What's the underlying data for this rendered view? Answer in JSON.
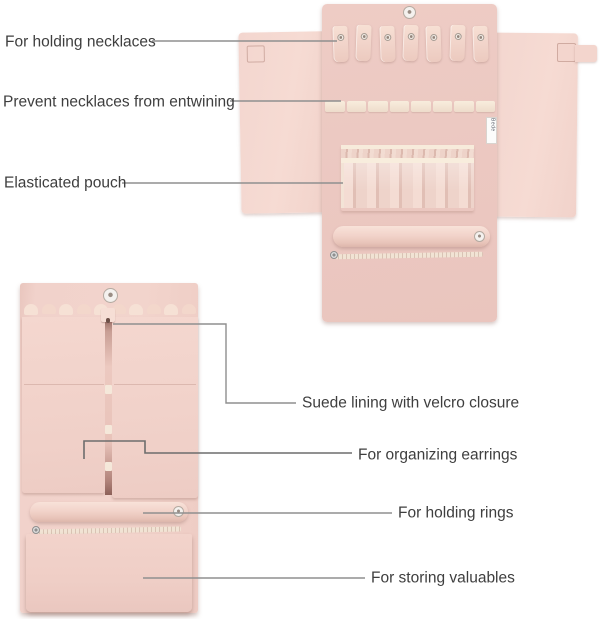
{
  "callouts": {
    "necklaces": "For holding necklaces",
    "entwining": "Prevent necklaces from entwining",
    "elastic_pouch": "Elasticated pouch",
    "suede": "Suede lining with velcro closure",
    "earrings": "For organizing earrings",
    "rings": "For holding rings",
    "valuables": "For storing valuables"
  },
  "photo_open": {
    "necklace_hook_count": 7,
    "divider_segment_count": 8,
    "brand_tag_text": "Bede"
  },
  "colors": {
    "background": "#ffffff",
    "fabric_pink": "#ecc9c2",
    "fabric_pink_light": "#f4d7d0",
    "trim_cream": "#f3e6d9",
    "label_text": "#3e3e3e",
    "callout_line": "#8f8f8f"
  }
}
